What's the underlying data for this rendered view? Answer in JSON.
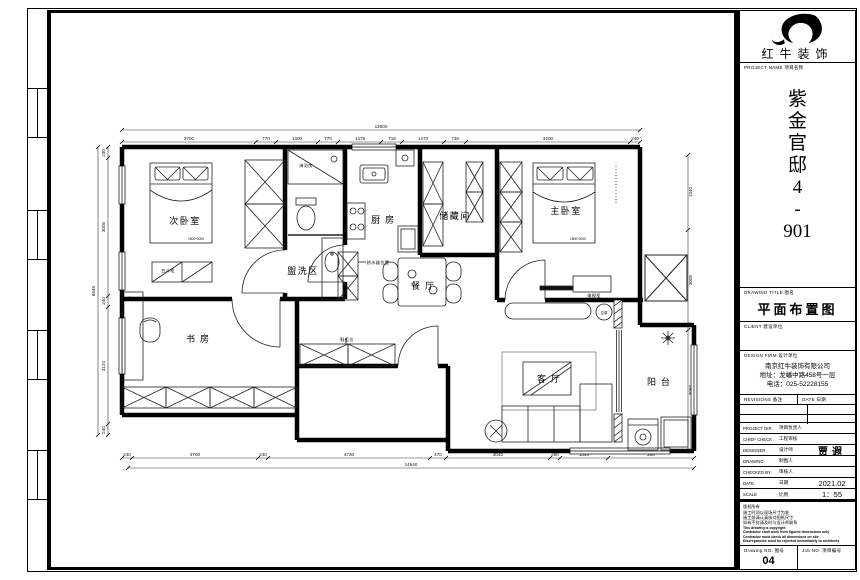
{
  "tb": {
    "logo_text": "红牛装饰",
    "project": {
      "en": "PROJECT NAME",
      "zh": "项目名称",
      "chars": [
        "紫",
        "金",
        "官",
        "邸",
        "4",
        "-",
        "901"
      ]
    },
    "title": {
      "en": "DRAWING TITLE",
      "zh": "图名",
      "value": "平面布置图"
    },
    "client": {
      "en": "CLIENT",
      "zh": "建设单位"
    },
    "firm": {
      "en": "DESIGN FIRM",
      "zh": "设计单位",
      "l1": "南京红牛装饰有限公司",
      "l2": "地址：龙蟠中路458号一层",
      "l3": "电话：025-52228155"
    },
    "rev": {
      "en": "REVISIONS",
      "zh": "备注",
      "den": "DATE",
      "dzh": "日期"
    },
    "people": [
      {
        "en": "PROJECT DIR.",
        "zh": "项目负责人",
        "val": ""
      },
      {
        "en": "CHIEF CHECK",
        "zh": "工程审核",
        "val": ""
      },
      {
        "en": "DESIGNER",
        "zh": "设计师",
        "val": "贾遐"
      },
      {
        "en": "DRAWING",
        "zh": "制图人",
        "val": ""
      },
      {
        "en": "CHECKED BY",
        "zh": "审核人",
        "val": ""
      },
      {
        "en": "DATE",
        "zh": "日期",
        "val": "2021.02"
      },
      {
        "en": "SCALE",
        "zh": "比例",
        "val": "1：55"
      }
    ],
    "notes": {
      "zh": [
        "版权所有",
        "施工时须以现场尺寸为准",
        "施工前请认真核对图纸尺寸",
        "如有不符请及时与设计师联系"
      ],
      "en": [
        "This drawing is copyright",
        "Contractor shall work from figured dimensions only",
        "Contractor must check all dimensions on site",
        "Discrepancies must be reported immediately to architects"
      ]
    },
    "no": {
      "den": "Drawing NO.",
      "dzh": "图号",
      "dval": "04",
      "jen": "Job NO.",
      "jzh": "项目编号"
    }
  },
  "plan": {
    "rooms": {
      "bedroom2": "次卧室",
      "study": "书房",
      "wash": "盥洗区",
      "kitchen": "厨房",
      "storage": "储藏间",
      "master": "主卧室",
      "dining": "餐厅",
      "living": "客厅",
      "balcony": "阳台"
    },
    "furn": {
      "shower": "淋浴房",
      "chest": "五斗柜",
      "desk": "写字台",
      "shoe": "鞋柜位",
      "heater": "热水器位置",
      "tvcab": "电视柜",
      "ac": "空调",
      "bed2_size": "1500*2000",
      "bed1_size": "1800*2000"
    },
    "dims": {
      "top_total": "13000",
      "top": [
        "3700",
        "770",
        "1400",
        "770",
        "1475",
        "718",
        "1470",
        "748",
        "3200",
        "240"
      ],
      "bottom": [
        "240",
        "3700",
        "240",
        "4730",
        "470",
        "3040",
        "280",
        "1340",
        "280"
      ],
      "bottom_total": "14640",
      "left": [
        "240",
        "3005",
        "240",
        "3120",
        "240"
      ],
      "left_total": "6845",
      "right": [
        "1340",
        "3005",
        "3060"
      ]
    }
  }
}
